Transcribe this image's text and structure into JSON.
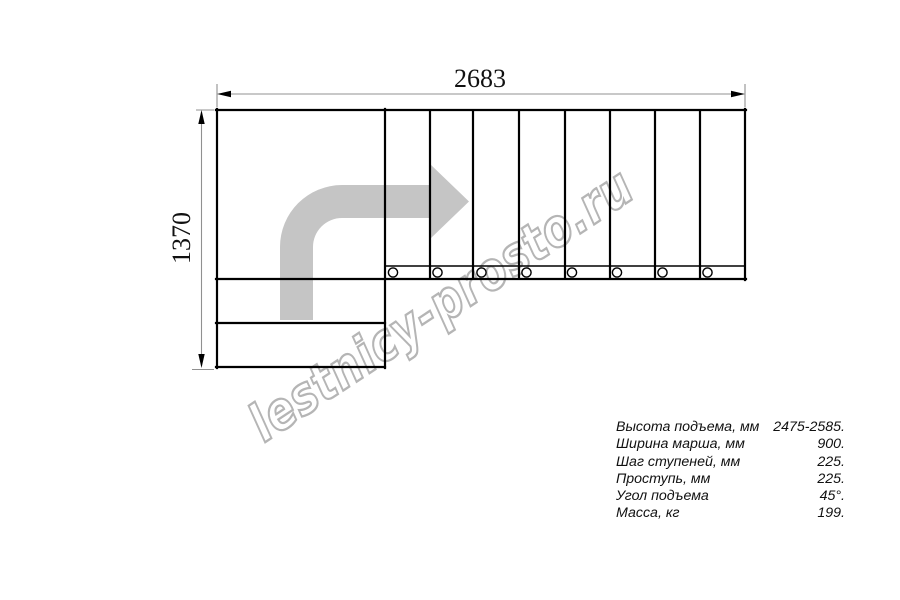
{
  "drawing": {
    "title": "staircase-plan-top-view",
    "dimension_width_mm": "2683",
    "dimension_height_mm": "1370",
    "watermark": "lestnicy-prosto.ru",
    "step_count": 8,
    "colors": {
      "background": "#ffffff",
      "line": "#000000",
      "dimension_line": "#909090",
      "direction_arrow": "#c5c5c5",
      "watermark": "#b5b5b5"
    }
  },
  "specs": {
    "rows": [
      {
        "label": "Высота подъема, мм",
        "value": "2475-2585."
      },
      {
        "label": "Ширина марша, мм",
        "value": "900."
      },
      {
        "label": "Шаг ступеней, мм",
        "value": "225."
      },
      {
        "label": "Проступь, мм",
        "value": "225."
      },
      {
        "label": "Угол подъема",
        "value": "45°."
      },
      {
        "label": "Масса, кг",
        "value": "199."
      }
    ]
  }
}
